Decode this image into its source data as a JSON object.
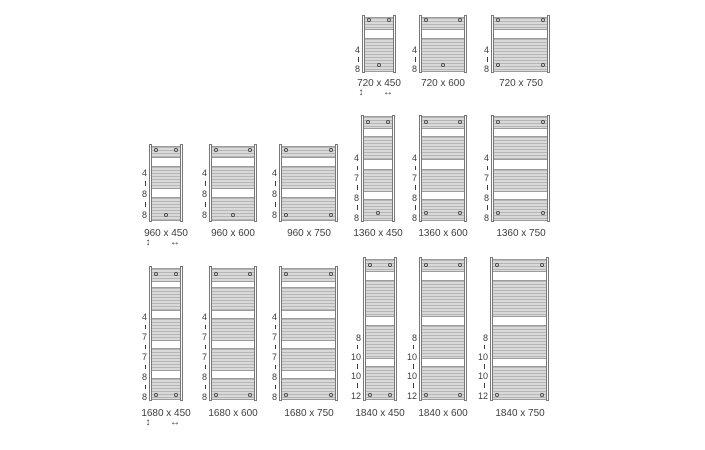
{
  "diagram_title": "towel radiator size chart",
  "colors": {
    "background": "#ffffff",
    "stripe_light": "#d9d9d9",
    "stripe_line": "#b6b6b6",
    "group_border": "#9c9c9c",
    "tube_border": "#787878",
    "tube_fill": "#fcfcfc",
    "text": "#3d3d3d",
    "plug_border": "#4a4a4a",
    "plug_fill": "#ededed"
  },
  "arrows": {
    "vertical": "↕",
    "horizontal": "↔"
  },
  "models": {
    "720": {
      "height": 58,
      "groups": [
        [
          1.5,
          13
        ],
        [
          22.5,
          34.5
        ]
      ],
      "top_plug_y": 5,
      "bottom_plug_y": 50,
      "stack": [
        [
          "4",
          35
        ],
        [
          "8",
          54
        ]
      ],
      "dash_right": 2
    },
    "960": {
      "height": 78,
      "groups": [
        [
          1.5,
          12.5
        ],
        [
          22,
          22.5
        ],
        [
          53,
          23.5
        ]
      ],
      "top_plug_y": 5.5,
      "bottom_plug_y": 71,
      "stack": [
        [
          "4",
          29
        ],
        [
          "8",
          50
        ],
        [
          "8",
          71
        ]
      ],
      "dash_right": 2
    },
    "1360": {
      "height": 107,
      "groups": [
        [
          1.5,
          12.5
        ],
        [
          21.5,
          23.5
        ],
        [
          54,
          23
        ],
        [
          84.5,
          21.5
        ]
      ],
      "top_plug_y": 7,
      "bottom_plug_y": 98.5,
      "stack": [
        [
          "4",
          43.5
        ],
        [
          "7",
          63.5
        ],
        [
          "8",
          83
        ],
        [
          "8",
          103.5
        ]
      ],
      "dash_right": 2
    },
    "1680": {
      "height": 135,
      "groups": [
        [
          1.5,
          14
        ],
        [
          21,
          23.5
        ],
        [
          52,
          22.5
        ],
        [
          81.5,
          23
        ],
        [
          111.5,
          22.5
        ]
      ],
      "top_plug_y": 8,
      "bottom_plug_y": 129,
      "stack": [
        [
          "4",
          51
        ],
        [
          "7",
          71
        ],
        [
          "7",
          91
        ],
        [
          "8",
          111
        ],
        [
          "8",
          131
        ]
      ],
      "dash_right": 2
    },
    "1840": {
      "height": 144,
      "groups": [
        [
          1.5,
          13.5
        ],
        [
          22.5,
          37.5
        ],
        [
          67.5,
          34
        ],
        [
          108.5,
          34.5
        ]
      ],
      "top_plug_y": 7.5,
      "bottom_plug_y": 137.5,
      "stack": [
        [
          "8",
          80.5
        ],
        [
          "10",
          100
        ],
        [
          "10",
          119
        ],
        [
          "12",
          138.5
        ]
      ],
      "dash_right": 4
    }
  },
  "radiators": [
    {
      "label": "720 x 450",
      "model": "720",
      "left": 362,
      "top": 15,
      "width": 34,
      "bottom_plugs": "center",
      "arrows": true,
      "label_y": 78
    },
    {
      "label": "720 x 600",
      "model": "720",
      "left": 419,
      "top": 15,
      "width": 48,
      "bottom_plugs": "center",
      "arrows": false,
      "label_y": 78
    },
    {
      "label": "720 x 750",
      "model": "720",
      "left": 491,
      "top": 15,
      "width": 59,
      "bottom_plugs": "sides",
      "arrows": false,
      "label_y": 78
    },
    {
      "label": "960 x 450",
      "model": "960",
      "left": 149,
      "top": 144,
      "width": 34,
      "bottom_plugs": "center",
      "arrows": true,
      "label_y": 228
    },
    {
      "label": "960 x 600",
      "model": "960",
      "left": 209,
      "top": 144,
      "width": 48,
      "bottom_plugs": "center",
      "arrows": false,
      "label_y": 228
    },
    {
      "label": "960 x 750",
      "model": "960",
      "left": 279,
      "top": 144,
      "width": 59,
      "bottom_plugs": "sides",
      "arrows": false,
      "label_y": 228
    },
    {
      "label": "1360 x 450",
      "model": "1360",
      "left": 361,
      "top": 114.5,
      "width": 34,
      "bottom_plugs": "center",
      "arrows": false,
      "label_y": 228
    },
    {
      "label": "1360 x 600",
      "model": "1360",
      "left": 419,
      "top": 114.5,
      "width": 48,
      "bottom_plugs": "sides",
      "arrows": false,
      "label_y": 228
    },
    {
      "label": "1360 x 750",
      "model": "1360",
      "left": 491,
      "top": 114.5,
      "width": 59,
      "bottom_plugs": "sides",
      "arrows": false,
      "label_y": 228
    },
    {
      "label": "1680 x 450",
      "model": "1680",
      "left": 149,
      "top": 266,
      "width": 34,
      "bottom_plugs": "sides",
      "arrows": true,
      "label_y": 408
    },
    {
      "label": "1680 x 600",
      "model": "1680",
      "left": 209,
      "top": 266,
      "width": 48,
      "bottom_plugs": "sides",
      "arrows": false,
      "label_y": 408
    },
    {
      "label": "1680 x 750",
      "model": "1680",
      "left": 279,
      "top": 266,
      "width": 59,
      "bottom_plugs": "sides",
      "arrows": false,
      "label_y": 408
    },
    {
      "label": "1840 x 450",
      "model": "1840",
      "left": 363,
      "top": 257,
      "width": 34,
      "bottom_plugs": "sides",
      "arrows": false,
      "label_y": 408
    },
    {
      "label": "1840 x 600",
      "model": "1840",
      "left": 419,
      "top": 257,
      "width": 48,
      "bottom_plugs": "sides",
      "arrows": false,
      "label_y": 408
    },
    {
      "label": "1840 x 750",
      "model": "1840",
      "left": 490,
      "top": 257,
      "width": 59,
      "bottom_plugs": "sides",
      "arrows": false,
      "label_y": 408
    }
  ]
}
